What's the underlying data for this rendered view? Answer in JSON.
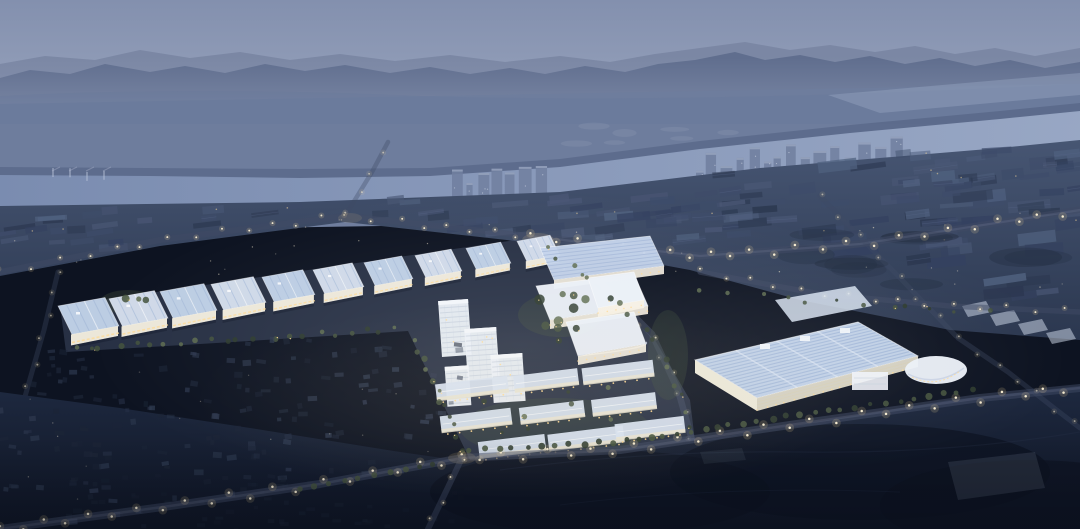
{
  "meta": {
    "type": "architectural-rendering",
    "subject": "aerial-industrial-campus-at-dusk",
    "description": "Bird's-eye dusk rendering of a brightly lit industrial park: a row of logistics warehouses, mid-rise blocks, white R&D halls, dormitory slabs and a large solar-roof factory, surrounded by dark urban villages, a wide river, distant high-rise skyline and hazy mountain ridges.",
    "visible_text": "none"
  },
  "colors": {
    "glow_white": "#ffffff",
    "vignette": "#0a0f1b",
    "sky_top": "#8390ae",
    "sky_horizon": "#9ba6bf",
    "mountain_far": "#75829f",
    "mountain_near": "#5d6b8c",
    "haze": "#8b97b3",
    "plain": "#6e7d9d",
    "river_light": "#9aa9c6",
    "river_dark": "#7b8db1",
    "shore": "#505f80",
    "distant_tower": "#71809f",
    "distant_tower_lit": "#b6c1d8",
    "distant_town": "#9aa7c0",
    "mid_top": "#475673",
    "mid_bottom": "#2b374f",
    "roof_dark_a": "#3e4c6a",
    "roof_dark_b": "#344160",
    "roof_dark_c": "#4a5775",
    "roof_blue_dim": "#50617f",
    "roof_white": "#eaeff7",
    "roof_pale": "#d6e0ef",
    "roof_solar": "#c3d3ea",
    "roof_stripe": "#9fb4d6",
    "facade_glow": "#f7f1e2",
    "window_warm": "#ffd993",
    "streetlight_core": "#fff3d6",
    "streetlight_glow": "#ffdf9e",
    "road_surface": "#3f4a63",
    "campus_ground": "#414e68",
    "green_dark": "#2e3b2d",
    "green_mid": "#44523d",
    "green_light": "#5e6c50",
    "village_block": "#2d384e",
    "village_dark": "#1c2537",
    "fg_top": "#1e2940",
    "fg_bottom": "#0d1321",
    "hill_dark": "#0b111e",
    "faint_structure": "#97a2b5"
  }
}
